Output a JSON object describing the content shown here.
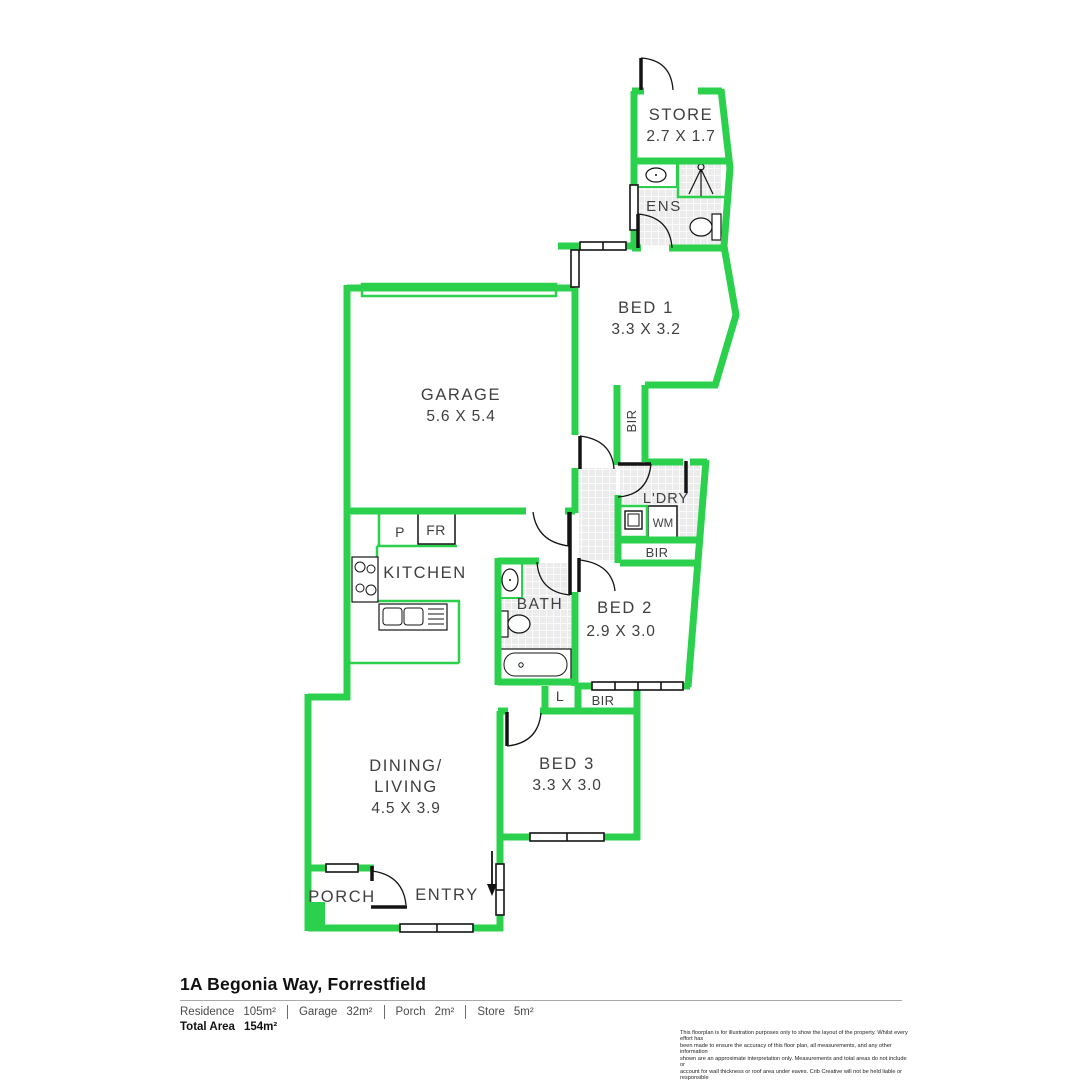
{
  "meta": {
    "address_title": "1A Begonia Way, Forrestfield"
  },
  "area_summary": {
    "items": [
      {
        "label": "Residence",
        "value": "105m²"
      },
      {
        "label": "Garage",
        "value": "32m²"
      },
      {
        "label": "Porch",
        "value": "2m²"
      },
      {
        "label": "Store",
        "value": "5m²"
      }
    ],
    "total_label": "Total Area",
    "total_value": "154m²"
  },
  "rooms": {
    "store": {
      "name": "STORE",
      "dims": "2.7 X 1.7"
    },
    "ens": {
      "name": "ENS"
    },
    "bed1": {
      "name": "BED 1",
      "dims": "3.3 X 3.2"
    },
    "garage": {
      "name": "GARAGE",
      "dims": "5.6 X 5.4"
    },
    "ldry": {
      "name": "L'DRY"
    },
    "kitchen": {
      "name": "KITCHEN"
    },
    "bath": {
      "name": "BATH"
    },
    "bed2": {
      "name": "BED 2",
      "dims": "2.9 X 3.0"
    },
    "bed3": {
      "name": "BED 3",
      "dims": "3.3 X 3.0"
    },
    "dining": {
      "line1": "DINING/",
      "line2": "LIVING",
      "dims": "4.5 X 3.9"
    },
    "porch": {
      "name": "PORCH"
    },
    "entry": {
      "name": "ENTRY"
    }
  },
  "fixtures": {
    "pantry": "P",
    "fridge": "FR",
    "washing_machine": "WM",
    "linen": "L"
  },
  "bir_labels": {
    "bed1": "BIR",
    "bed2": "BIR",
    "bed3": "BIR"
  },
  "colors": {
    "wall_green": "#2bd04c",
    "door_black": "#141414",
    "label_gray": "#3f3f3f"
  },
  "disclaimer": {
    "lines": [
      "This floorplan is for illustration purposes only to show the layout of the property. Whilst every effort has",
      "been made to ensure the accuracy of this floor plan, all measurements, and any other information",
      "shown are an approximate interpretation only. Measurements and total areas do not include or",
      "account for wall thickness or roof area under eaves. Crib Creative will not be held liable or responsible",
      "for any error, omission, misrepresentation or use of any information shown on the final floor plan.",
      "Not to be used for any other purposes.",
      "www.cribcreative.com.au"
    ]
  }
}
